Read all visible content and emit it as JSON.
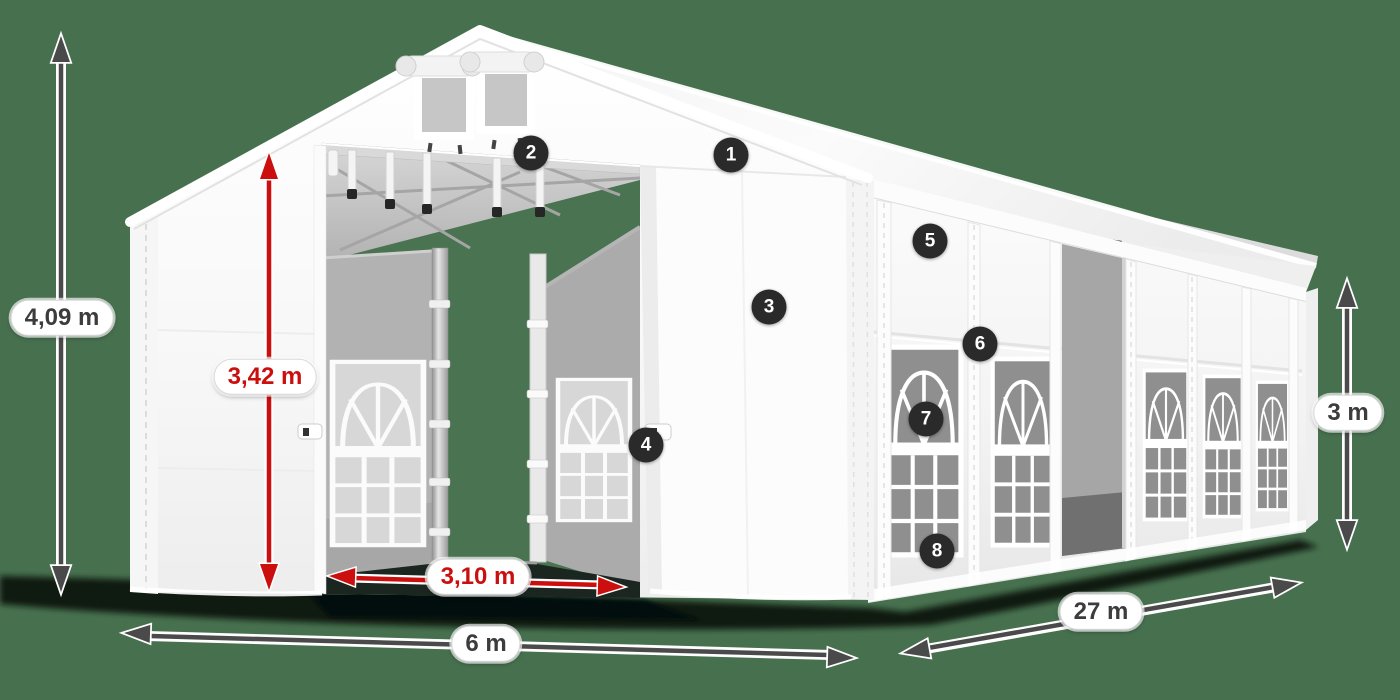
{
  "diagram_subject": "party tent with dimension annotations",
  "colors": {
    "background": "#47704F",
    "dimension_red": "#CB0E0E",
    "dimension_gray": "#4A4A4A",
    "badge_background": "#2A2A2A",
    "pill_background": "#FFFFFF",
    "tent_fabric": "#F6F6F6"
  },
  "measurements": {
    "total_height": {
      "label": "4,09 m",
      "style": "gray"
    },
    "inner_height": {
      "label": "3,42 m",
      "style": "red"
    },
    "entrance_width": {
      "label": "3,10 m",
      "style": "red"
    },
    "width": {
      "label": "6 m",
      "style": "gray"
    },
    "length": {
      "label": "27 m",
      "style": "gray"
    },
    "side_height": {
      "label": "3 m",
      "style": "gray"
    }
  },
  "callouts": [
    {
      "number": "1"
    },
    {
      "number": "2"
    },
    {
      "number": "3"
    },
    {
      "number": "4"
    },
    {
      "number": "5"
    },
    {
      "number": "6"
    },
    {
      "number": "7"
    },
    {
      "number": "8"
    }
  ]
}
